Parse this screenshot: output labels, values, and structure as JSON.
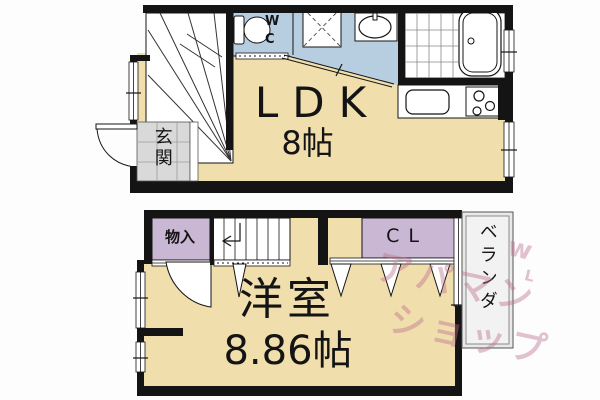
{
  "floorplan": {
    "floor1": {
      "rooms": {
        "ldk": {
          "label": "LDK",
          "size": "8帖"
        },
        "entrance": {
          "label": "玄関"
        },
        "wc": {
          "label": "W\nC"
        }
      }
    },
    "floor2": {
      "rooms": {
        "western_room": {
          "label": "洋室",
          "size": "8.86帖"
        },
        "storage": {
          "label": "物入"
        },
        "closet": {
          "label": "CL"
        },
        "veranda": {
          "label": "ベランダ"
        }
      }
    },
    "watermark": {
      "line1": "アパマン",
      "line2": "ショップ",
      "mark1": "w",
      "mark2": "L"
    },
    "colors": {
      "room_beige": "#f1dead",
      "wet_area_blue": "#b7cee1",
      "closet_purple": "#cab7d3",
      "entrance_tile_gray": "#d9d9d9",
      "veranda_gray": "#e9e9e9",
      "wall_black": "#141414",
      "watermark_pink": "#c984a8"
    }
  }
}
